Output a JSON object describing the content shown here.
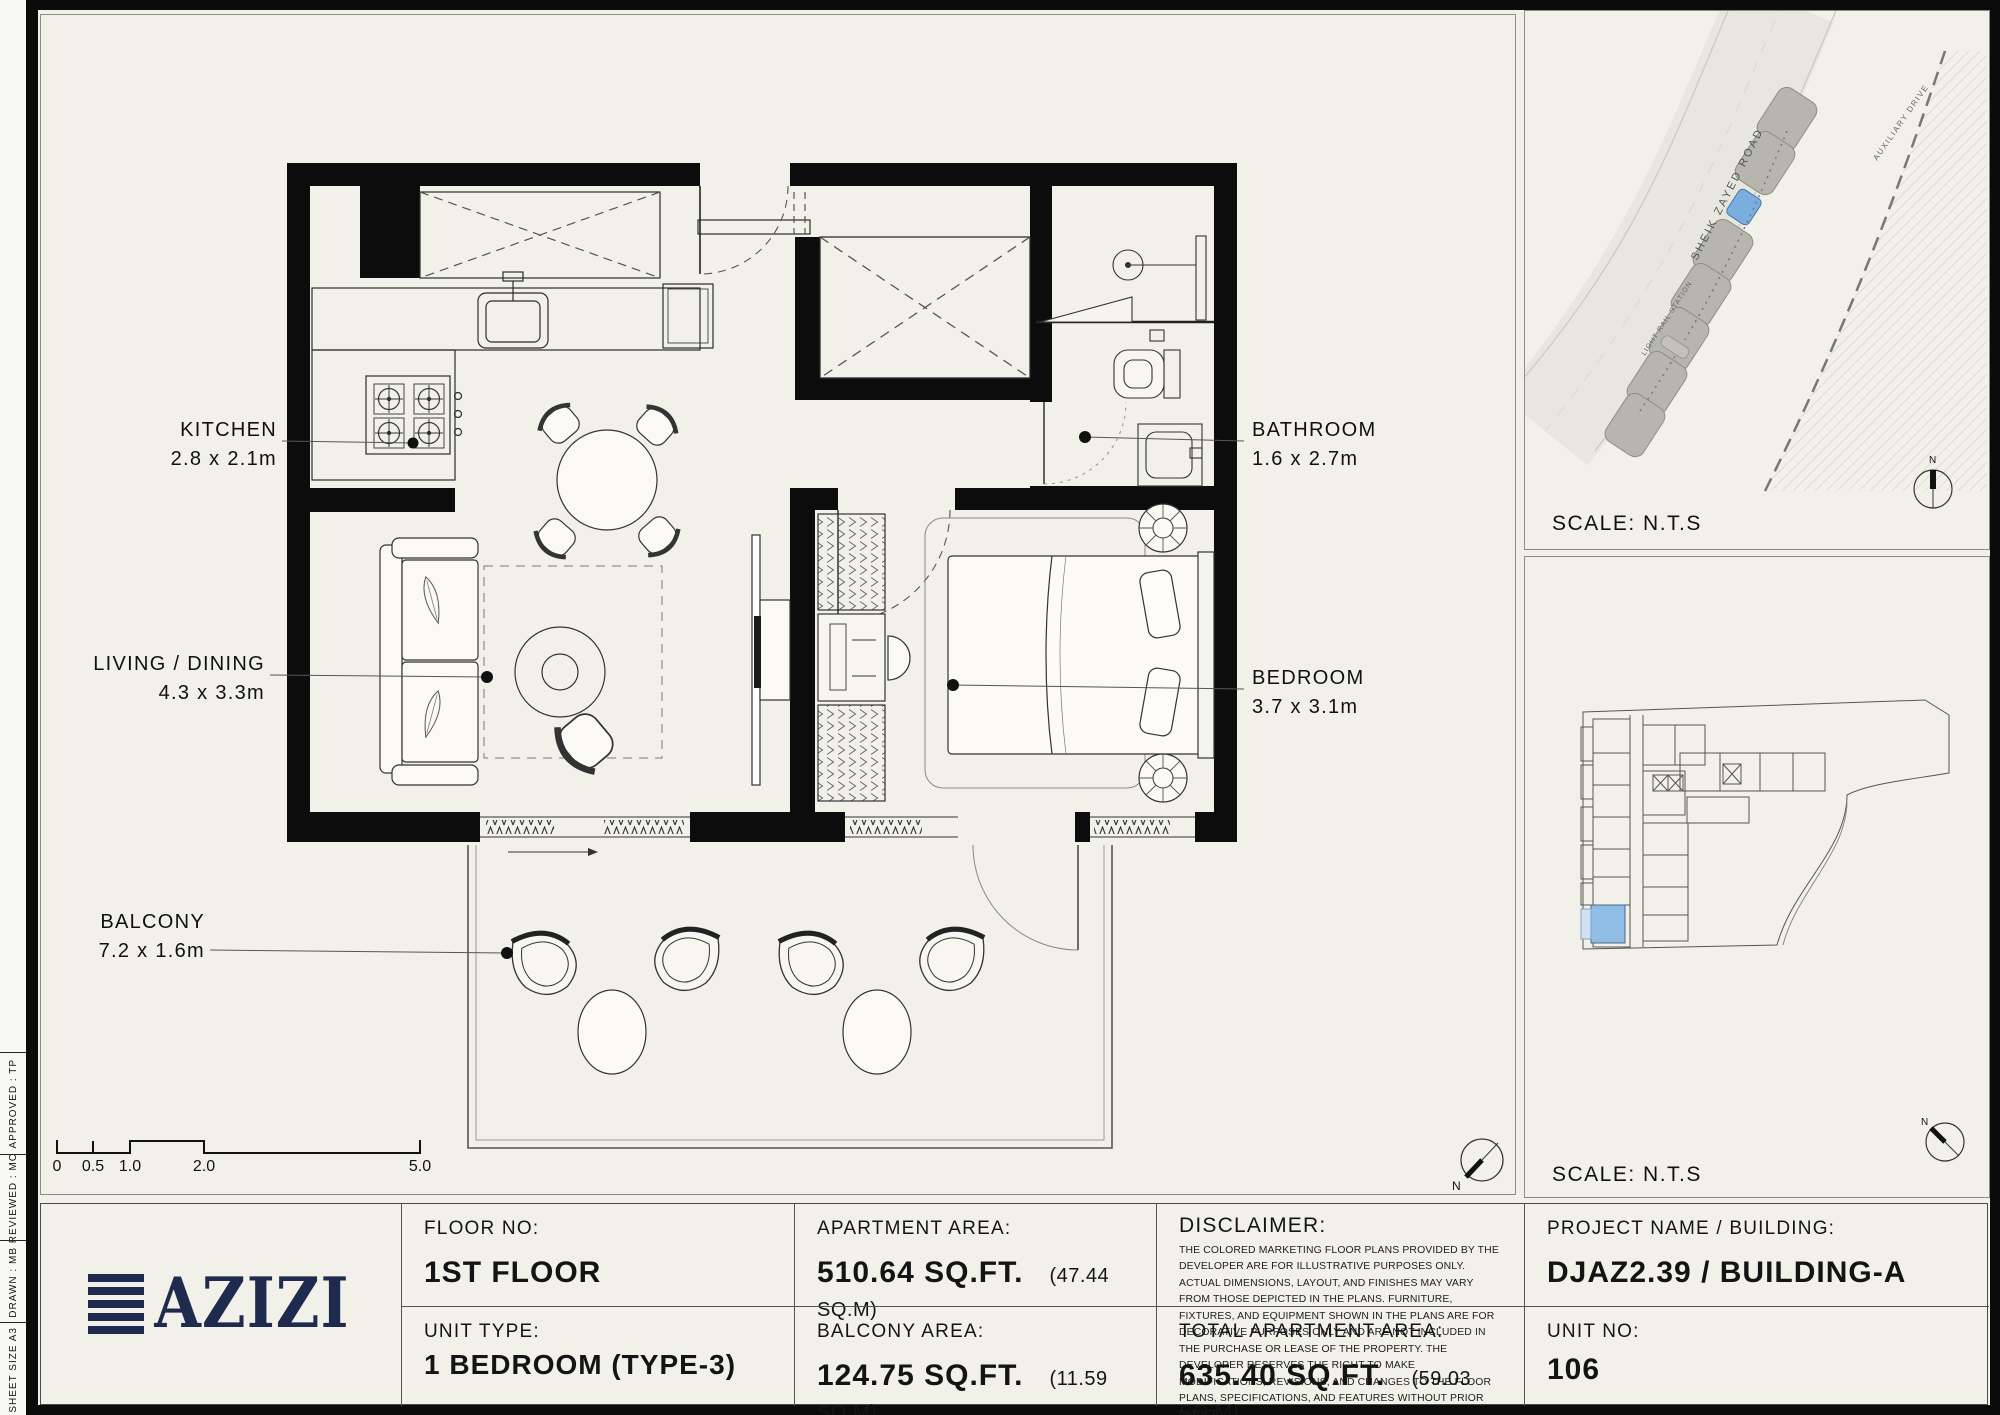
{
  "sheet_margin": {
    "items": [
      {
        "label": "APPROVED :   TP"
      },
      {
        "label": "REVIEWED :   MC"
      },
      {
        "label": "DRAWN :   MB"
      },
      {
        "label": "SHEET SIZE A3"
      }
    ]
  },
  "floor_plan": {
    "north": "N",
    "rooms": [
      {
        "name": "KITCHEN",
        "dims": "2.8 x 2.1m"
      },
      {
        "name": "LIVING / DINING",
        "dims": "4.3 x 3.3m"
      },
      {
        "name": "BALCONY",
        "dims": "7.2 x 1.6m"
      },
      {
        "name": "BATHROOM",
        "dims": "1.6 x 2.7m"
      },
      {
        "name": "BEDROOM",
        "dims": "3.7 x 3.1m"
      }
    ],
    "scale_bar": {
      "ticks": [
        "0",
        "0.5",
        "1.0",
        "2.0",
        "5.0"
      ]
    }
  },
  "panels": {
    "site_map": {
      "scale_label": "SCALE: N.T.S",
      "road_label": "SHEIK ZAYED ROAD",
      "auxiliary_label": "AUXILIARY DRIVE",
      "station_label": "LIGHT RAIL STATION",
      "north": "N"
    },
    "key_plan": {
      "scale_label": "SCALE: N.T.S",
      "north": "N"
    }
  },
  "title_block": {
    "brand": "AZIZI",
    "floor": {
      "label": "FLOOR NO:",
      "value": "1ST FLOOR"
    },
    "unit_type": {
      "label": "UNIT TYPE:",
      "value": "1 BEDROOM (TYPE-3)"
    },
    "apartment_area": {
      "label": "APARTMENT AREA:",
      "value": "510.64 SQ.FT.",
      "metric": "(47.44 SQ.M)"
    },
    "balcony_area": {
      "label": "BALCONY AREA:",
      "value": "124.75 SQ.FT.",
      "metric": "(11.59 SQ.M)"
    },
    "disclaimer": {
      "label": "DISCLAIMER:",
      "text": "THE COLORED MARKETING FLOOR PLANS PROVIDED BY THE DEVELOPER ARE FOR ILLUSTRATIVE PURPOSES ONLY. ACTUAL DIMENSIONS, LAYOUT, AND FINISHES MAY VARY FROM THOSE DEPICTED IN THE PLANS. FURNITURE, FIXTURES, AND EQUIPMENT SHOWN IN THE PLANS ARE FOR DECORATIVE PURPOSES ONLY AND ARE NOT INCLUDED IN THE PURCHASE OR LEASE OF THE PROPERTY. THE DEVELOPER RESERVES THE RIGHT TO MAKE MODIFICATIONS, REVISIONS, AND CHANGES TO THE FLOOR PLANS, SPECIFICATIONS, AND FEATURES WITHOUT PRIOR NOTICE."
    },
    "total_area": {
      "label": "TOTAL APARTMENT AREA:",
      "value": "635.40 SQ.FT.",
      "metric": "(59.03 SQ.M)"
    },
    "project": {
      "label": "PROJECT NAME / BUILDING:",
      "value": "DJAZ2.39 / BUILDING-A"
    },
    "unit_no": {
      "label": "UNIT NO:",
      "value": "106"
    }
  },
  "colors": {
    "paper": "#f2f1e9",
    "wall_black": "#0c0c0c",
    "brand_navy": "#1f2b4e",
    "highlight_blue": "#8fbde4",
    "site_plot_blue": "#79aede"
  }
}
